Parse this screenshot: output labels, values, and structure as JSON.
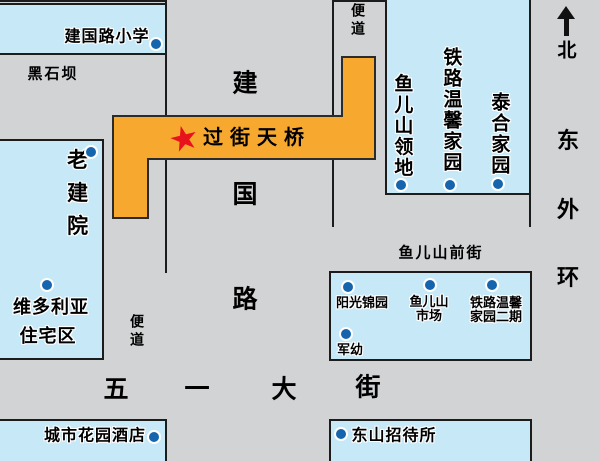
{
  "compass": {
    "north": "北",
    "ring_road": [
      "东",
      "外",
      "环"
    ]
  },
  "roads": {
    "heishiba": "黑石坝",
    "jianguo_road": [
      "建",
      "国",
      "路"
    ],
    "wuyi_street": [
      "五",
      "一",
      "大",
      "街"
    ],
    "yuershan_front_street": "鱼儿山前街",
    "sidewalk_right": "便道",
    "sidewalk_left": "便道"
  },
  "bridge": {
    "label": "过街天桥",
    "star_glyph": "★"
  },
  "buildings": {
    "jianguolu_primary_school": "建国路小学",
    "lao_jian_yuan": "老建院",
    "victoria_line1": "维多利亚",
    "victoria_line2": "住宅区",
    "yuershan_lingdi": "鱼儿山领地",
    "tielu_wenxin_jiayuan": "铁路温馨家园",
    "taihe_jiayuan": "泰合家园",
    "yangguang_jinyuan": "阳光锦园",
    "yuershan_market_line1": "鱼儿山",
    "yuershan_market_line2": "市场",
    "tielu_phase2_line1": "铁路温馨",
    "tielu_phase2_line2": "家园二期",
    "jun_you": "军幼",
    "city_garden_hotel": "城市花园酒店",
    "dongshan_guesthouse": "东山招待所"
  },
  "colors": {
    "road_bg": "#d2d3d5",
    "building_fill": "#c6e8f7",
    "outline_black": "#1c1c1c",
    "bridge_fill": "#f7a92f",
    "bridge_outline": "#2b2b2b",
    "marker_blue": "#1565ae",
    "star_red": "#e8121c"
  }
}
